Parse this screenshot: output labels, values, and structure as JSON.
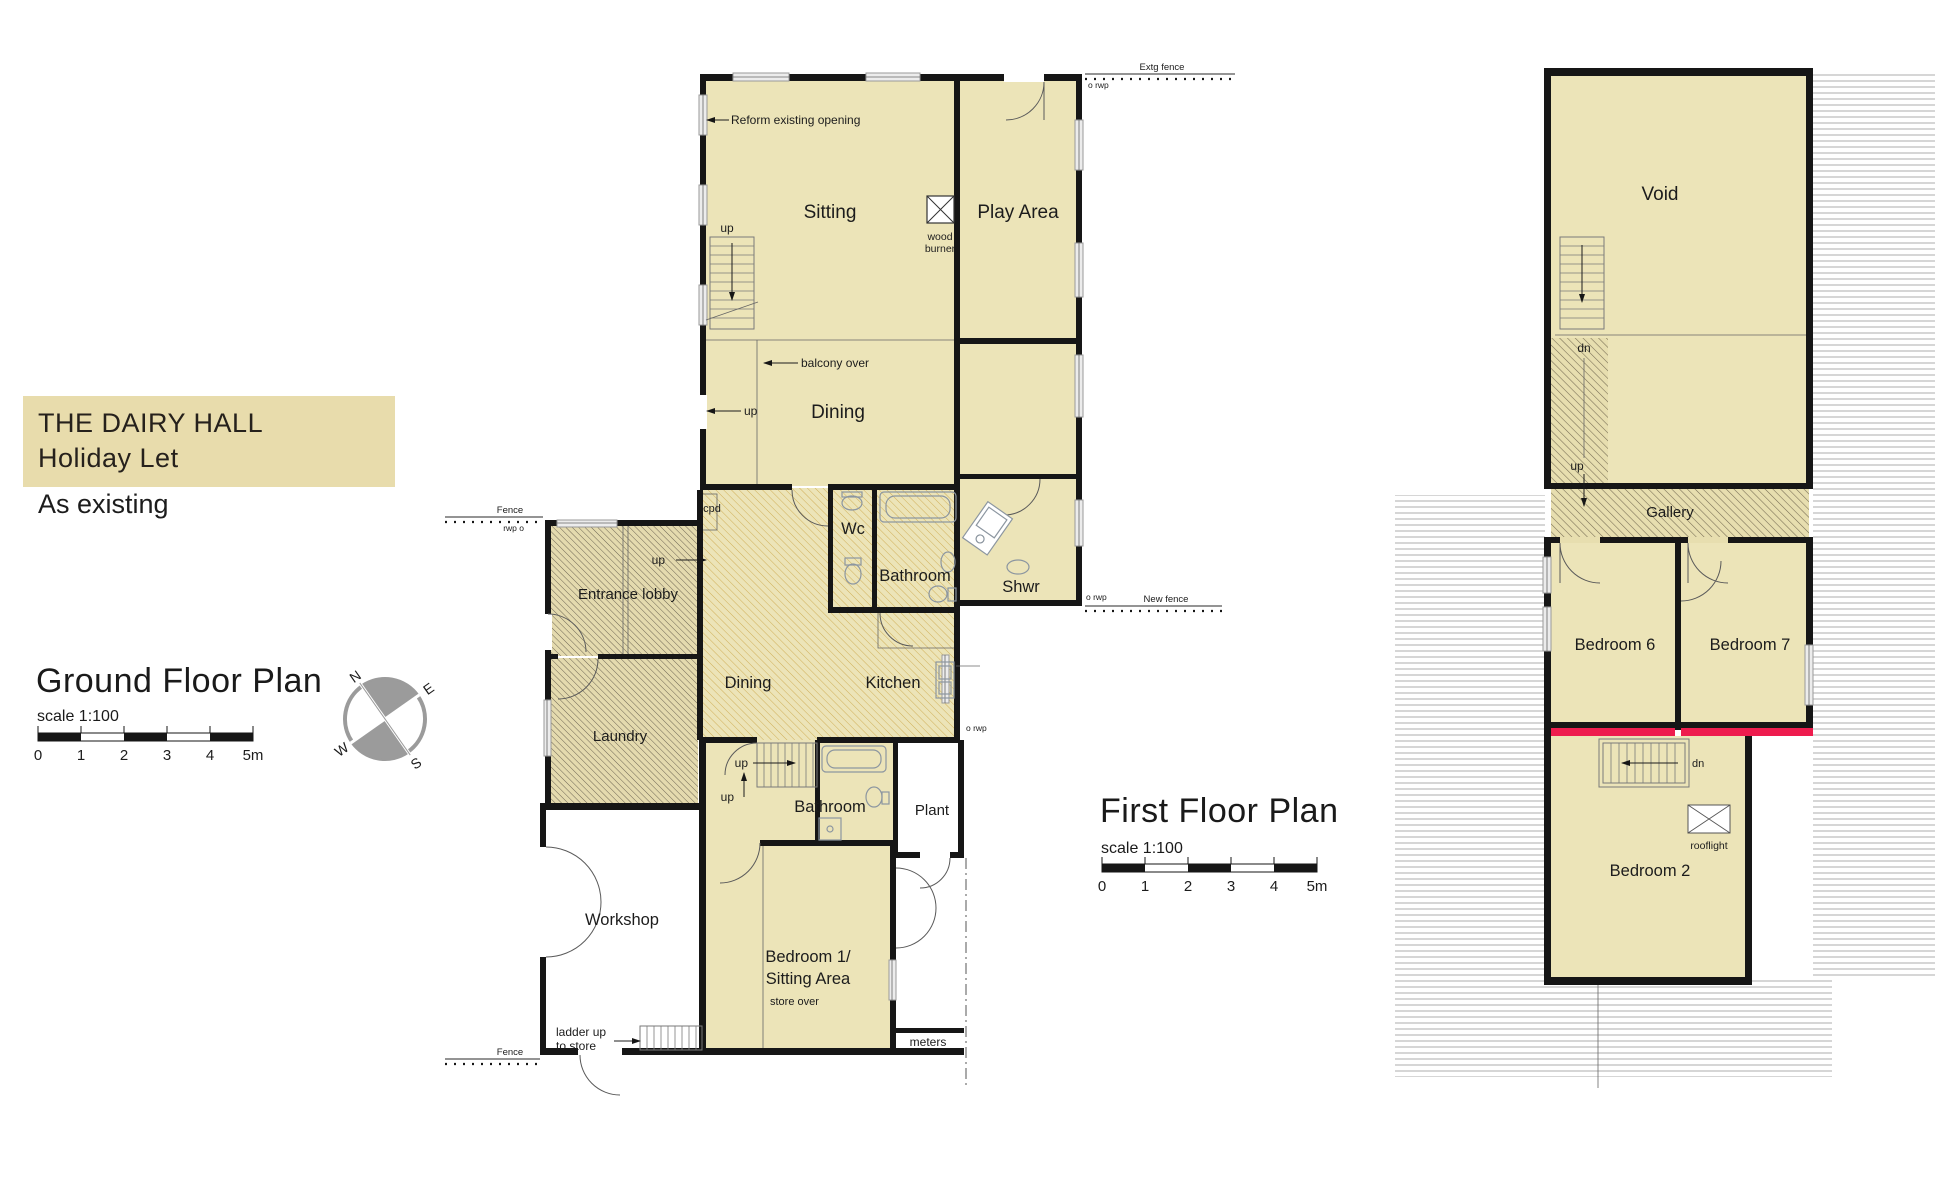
{
  "colors": {
    "room_fill": "#ECE4B8",
    "title_fill": "#E8DCAC",
    "wall": "#161616",
    "highlight_red": "#EE1C4E",
    "roof_line": "#9A9A9A",
    "compass_gray": "#9B9B9B"
  },
  "title_block": {
    "line1": "THE DAIRY HALL",
    "line2": "Holiday Let",
    "subtitle": "As existing"
  },
  "ground_floor": {
    "heading": "Ground Floor Plan",
    "scale_label": "scale 1:100",
    "ticks": [
      "0",
      "1",
      "2",
      "3",
      "4",
      "5m"
    ],
    "rooms": {
      "sitting": "Sitting",
      "play_area": "Play Area",
      "dining_upper": "Dining",
      "wc": "Wc",
      "bathroom_upper": "Bathroom",
      "shwr": "Shwr",
      "entrance_lobby": "Entrance lobby",
      "dining_main": "Dining",
      "kitchen": "Kitchen",
      "laundry": "Laundry",
      "bathroom_lower": "Bathroom",
      "plant": "Plant",
      "workshop": "Workshop",
      "bedroom1_line1": "Bedroom 1/",
      "bedroom1_line2": "Sitting Area"
    },
    "annotations": {
      "reform": "Reform existing opening",
      "wood_line1": "wood",
      "wood_line2": "burner",
      "balcony_over": "balcony over",
      "up": "up",
      "cpd": "cpd",
      "store_over": "store over",
      "ladder_line1": "ladder up",
      "ladder_line2": "to store",
      "meters": "meters",
      "extg_fence": "Extg fence",
      "new_fence": "New fence",
      "fence": "Fence",
      "rwp": "o rwp",
      "rwp_left": "rwp o"
    }
  },
  "first_floor": {
    "heading": "First Floor Plan",
    "scale_label": "scale 1:100",
    "ticks": [
      "0",
      "1",
      "2",
      "3",
      "4",
      "5m"
    ],
    "rooms": {
      "void": "Void",
      "gallery": "Gallery",
      "bedroom6": "Bedroom 6",
      "bedroom7": "Bedroom 7",
      "bedroom2": "Bedroom 2"
    },
    "annotations": {
      "dn": "dn",
      "up": "up",
      "rooflight": "rooflight"
    }
  },
  "compass": {
    "n": "N",
    "e": "E",
    "s": "S",
    "w": "W"
  }
}
